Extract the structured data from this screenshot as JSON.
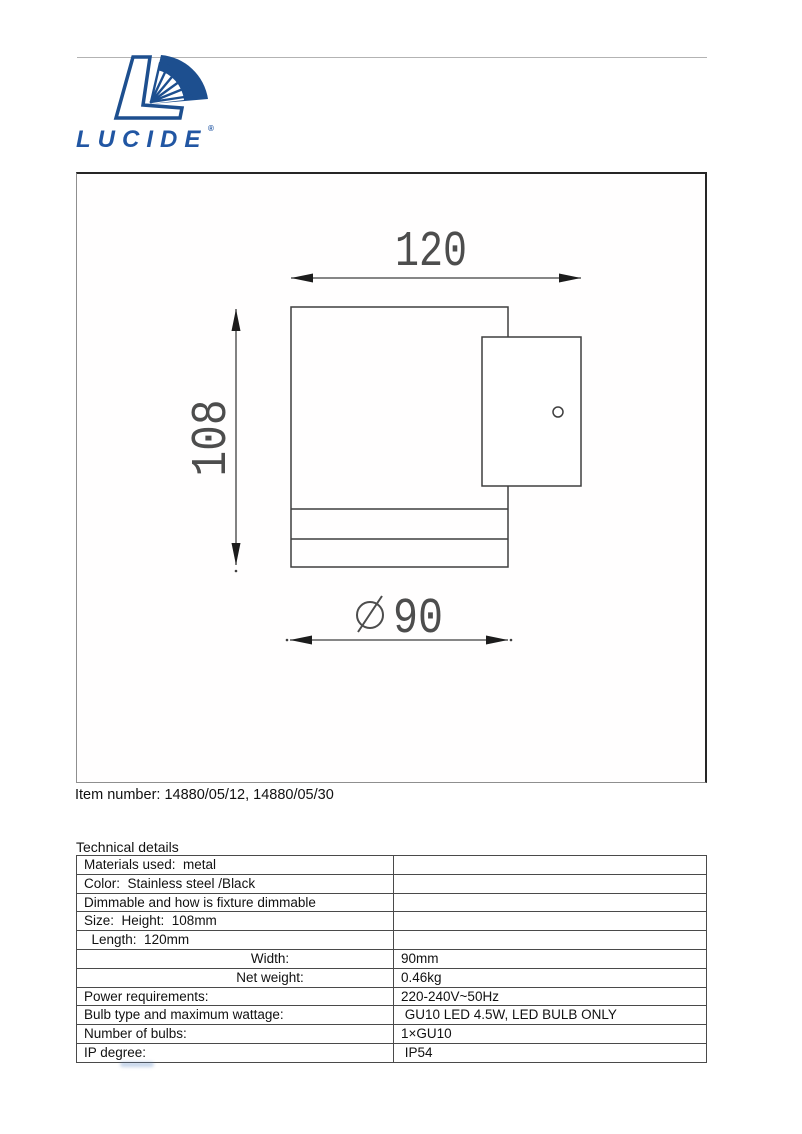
{
  "logo": {
    "brand": "LUCIDE",
    "registered_mark": "®",
    "brand_color": "#2156a3",
    "emblem_color": "#1d4f8f"
  },
  "drawing": {
    "dim_depth": "120",
    "dim_height": "108",
    "dim_diameter": "90",
    "diameter_symbol": "∅",
    "line_color": "#3f3f3f",
    "dim_text_color": "#4d4d4d"
  },
  "item_number": "Item number: 14880/05/12, 14880/05/30",
  "technical": {
    "heading": "Technical details",
    "rows": [
      {
        "label": "Materials used:  metal",
        "value": ""
      },
      {
        "label": "Color:  Stainless steel /Black",
        "value": ""
      },
      {
        "label": "Dimmable and how is fixture dimmable",
        "value": ""
      },
      {
        "label": "Size:  Height:  108mm",
        "value": ""
      },
      {
        "label": "  Length:  120mm",
        "value": ""
      },
      {
        "label": "Width:",
        "value": "90mm"
      },
      {
        "label": "Net weight:",
        "value": "0.46kg"
      },
      {
        "label": "Power requirements:",
        "value": "220-240V~50Hz"
      },
      {
        "label": "Bulb type and maximum wattage:",
        "value": " GU10 LED 4.5W, LED BULB ONLY"
      },
      {
        "label": "Number of bulbs:",
        "value": "1×GU10"
      },
      {
        "label": "IP degree:",
        "value": " IP54"
      }
    ]
  }
}
